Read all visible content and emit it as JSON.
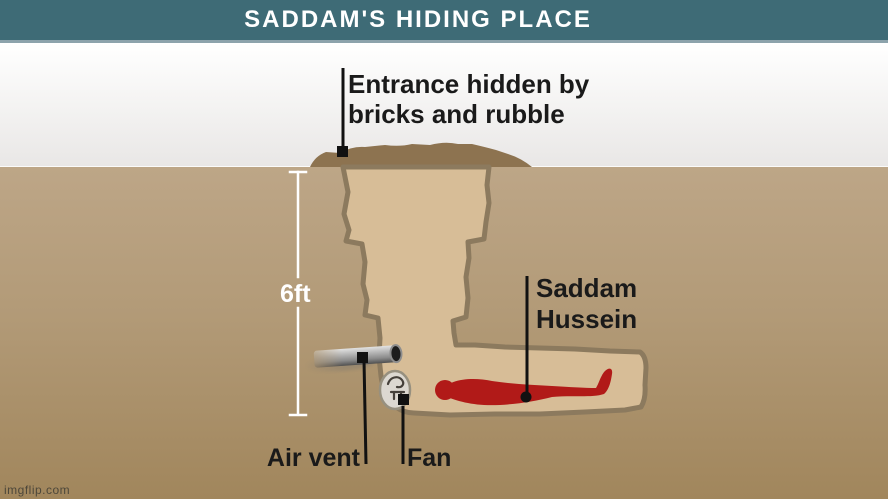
{
  "header": {
    "title": "SADDAM'S HIDING PLACE"
  },
  "diagram": {
    "entrance_label": {
      "line1": "Entrance hidden by",
      "line2": "bricks and rubble"
    },
    "depth_label": "6ft",
    "person_label": {
      "line1": "Saddam",
      "line2": "Hussein"
    },
    "air_vent_label": "Air vent",
    "fan_label": "Fan"
  },
  "watermark": "imgflip.com",
  "colors": {
    "header_bg": "#3e6b76",
    "header_underline": "#8ca3ac",
    "sky_top": "#ffffff",
    "sky_bottom": "#e9e7e6",
    "ground_top": "#bda687",
    "ground_bottom": "#a1865c",
    "rubble": "#8d7350",
    "hole_fill": "#d7bd97",
    "hole_outline": "#8c7a5e",
    "figure_red": "#b11a18",
    "pipe_gray": "#a8a8a8",
    "fan_body": "#dcd8d1",
    "label_color": "#1a1a1a",
    "measure_color": "#ffffff"
  }
}
